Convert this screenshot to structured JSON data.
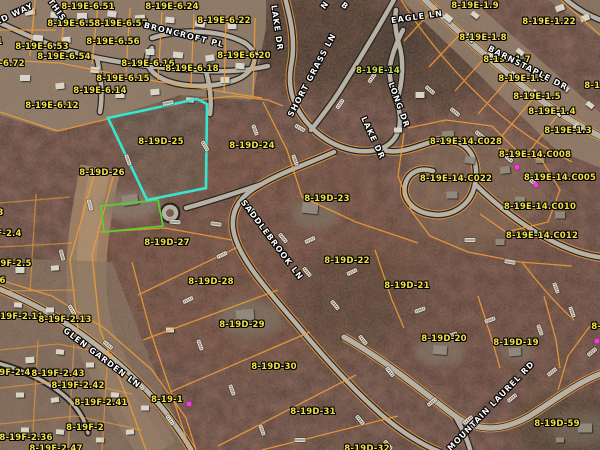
{
  "map": {
    "selected_parcel": "8-19D-25",
    "colors": {
      "highlight": "#38e6d0",
      "green_parcel": "#5ccc30",
      "parcel_line": "#ef9d38",
      "parcel_label": "#f2e245",
      "street_label": "#ffffff",
      "marker_magenta": "#f23ae2"
    },
    "parcel_labels": [
      {
        "t": "8-19E-6.51",
        "x": 88,
        "y": 7
      },
      {
        "t": "8-19E-6.24",
        "x": 172,
        "y": 7
      },
      {
        "t": "8-19E-6.52",
        "x": 74,
        "y": 24
      },
      {
        "t": "8-19E-6.57",
        "x": 121,
        "y": 24
      },
      {
        "t": "8-19E-6.22",
        "x": 224,
        "y": 21
      },
      {
        "t": "8-19E-6.56",
        "x": 113,
        "y": 42
      },
      {
        "t": "8-19E-6.53",
        "x": 42,
        "y": 47
      },
      {
        "t": "8-19E-6.54",
        "x": 64,
        "y": 57
      },
      {
        "t": "8-19E-6.20",
        "x": 244,
        "y": 56
      },
      {
        "t": "8-19E-6.16",
        "x": 148,
        "y": 64
      },
      {
        "t": "8-19E-6.18",
        "x": 192,
        "y": 69
      },
      {
        "t": "8-19E-6.15",
        "x": 123,
        "y": 79
      },
      {
        "t": "8-19E-6.14",
        "x": 100,
        "y": 91
      },
      {
        "t": "8-19E-6.12",
        "x": 52,
        "y": 106
      },
      {
        "t": "8-19E-6.72",
        "x": -2,
        "y": 64
      },
      {
        "t": "8-19E-6.71",
        "x": -24,
        "y": 42
      },
      {
        "t": "8-19E-14",
        "x": 378,
        "y": 71,
        "c": "#cde24c"
      },
      {
        "t": "8-19E-1.9",
        "x": 475,
        "y": 6
      },
      {
        "t": "8-19E-1.22",
        "x": 549,
        "y": 22
      },
      {
        "t": "8-19E-1.8",
        "x": 483,
        "y": 38
      },
      {
        "t": "8-19E-1.7",
        "x": 507,
        "y": 60
      },
      {
        "t": "8-19E-1.6",
        "x": 522,
        "y": 79
      },
      {
        "t": "8-19E-1.5",
        "x": 537,
        "y": 97
      },
      {
        "t": "8-19E-1.4",
        "x": 552,
        "y": 112
      },
      {
        "t": "8-19E-1.3",
        "x": 568,
        "y": 131
      },
      {
        "t": "8-19E-1.2",
        "x": 608,
        "y": 86
      },
      {
        "t": "8-19E-14.C028",
        "x": 466,
        "y": 142
      },
      {
        "t": "8-19E-14.C008",
        "x": 535,
        "y": 155
      },
      {
        "t": "8-19E-14.C022",
        "x": 456,
        "y": 179
      },
      {
        "t": "8-19E-14.C005",
        "x": 560,
        "y": 178
      },
      {
        "t": "8-19E-14.C010",
        "x": 540,
        "y": 207
      },
      {
        "t": "8-19E-14.C012",
        "x": 542,
        "y": 236
      },
      {
        "t": "8-19D-25",
        "x": 161,
        "y": 142
      },
      {
        "t": "8-19D-24",
        "x": 252,
        "y": 146
      },
      {
        "t": "8-19D-26",
        "x": 102,
        "y": 173
      },
      {
        "t": "8-19D-23",
        "x": 327,
        "y": 199
      },
      {
        "t": "8-19D-22",
        "x": 347,
        "y": 261
      },
      {
        "t": "8-19D-21",
        "x": 407,
        "y": 286
      },
      {
        "t": "8-19D-27",
        "x": 167,
        "y": 243
      },
      {
        "t": "8-19D-28",
        "x": 211,
        "y": 282
      },
      {
        "t": "8-19D-29",
        "x": 242,
        "y": 325
      },
      {
        "t": "8-19D-30",
        "x": 274,
        "y": 367
      },
      {
        "t": "8-19D-31",
        "x": 313,
        "y": 412
      },
      {
        "t": "8-19D-20",
        "x": 444,
        "y": 339
      },
      {
        "t": "8-19D-19",
        "x": 516,
        "y": 343
      },
      {
        "t": "8-19D-59",
        "x": 557,
        "y": 424
      },
      {
        "t": "8-19D-18",
        "x": 614,
        "y": 327
      },
      {
        "t": "8-19D-32",
        "x": 367,
        "y": 449
      },
      {
        "t": "8-19-1",
        "x": 167,
        "y": 400
      },
      {
        "t": "8-19F-2.3",
        "x": -20,
        "y": 213
      },
      {
        "t": "8-19F-2.4",
        "x": -2,
        "y": 234
      },
      {
        "t": "8-19F-2.5",
        "x": 8,
        "y": 264
      },
      {
        "t": "8-19F-2.6",
        "x": -18,
        "y": 281
      },
      {
        "t": "8-19F-2.11",
        "x": 17,
        "y": 317
      },
      {
        "t": "8-19F-2.13",
        "x": 65,
        "y": 320
      },
      {
        "t": "8-19F-2.45",
        "x": 10,
        "y": 373
      },
      {
        "t": "8-19F-2.43",
        "x": 58,
        "y": 374
      },
      {
        "t": "8-19F-2.42",
        "x": 78,
        "y": 386
      },
      {
        "t": "8-19F-2.41",
        "x": 101,
        "y": 403
      },
      {
        "t": "8-19F-2",
        "x": 85,
        "y": 428
      },
      {
        "t": "8-19F-2.36",
        "x": 26,
        "y": 438
      },
      {
        "t": "8-19F-2.47",
        "x": 56,
        "y": 449
      }
    ],
    "street_labels": [
      {
        "t": "RD WAY",
        "x": 14,
        "y": 14,
        "r": -25
      },
      {
        "t": "THIS",
        "x": 57,
        "y": 10,
        "r": 55
      },
      {
        "t": "BRONCROFT PL",
        "x": 184,
        "y": 35,
        "r": 14
      },
      {
        "t": "EAGLE LN",
        "x": 417,
        "y": 17,
        "r": -8
      },
      {
        "t": "LAKE DR",
        "x": 277,
        "y": 28,
        "r": 82
      },
      {
        "t": "SHORT GRASS LN",
        "x": 312,
        "y": 75,
        "r": -62
      },
      {
        "t": "BARNSTAPLE DR",
        "x": 528,
        "y": 68,
        "r": 27
      },
      {
        "t": "LONG DR",
        "x": 399,
        "y": 105,
        "r": 70
      },
      {
        "t": "LAKE DR",
        "x": 373,
        "y": 138,
        "r": 65
      },
      {
        "t": "SADDLEBROOK LN",
        "x": 272,
        "y": 240,
        "r": 53
      },
      {
        "t": "GLEN GARDEN LN",
        "x": 102,
        "y": 358,
        "r": 37
      },
      {
        "t": "MOUNTAIN LAUREL RD",
        "x": 491,
        "y": 406,
        "r": -46
      },
      {
        "t": "N",
        "x": 325,
        "y": 5,
        "r": -55
      },
      {
        "t": "B",
        "x": 345,
        "y": 6,
        "r": 40
      }
    ],
    "magenta_markers": [
      [
        517,
        167
      ],
      [
        536,
        185
      ],
      [
        189,
        404
      ],
      [
        597,
        341
      ]
    ],
    "dimension_markers": [
      [
        168,
        103,
        -12
      ],
      [
        205,
        146,
        60
      ],
      [
        128,
        160,
        70
      ],
      [
        175,
        222,
        5
      ],
      [
        216,
        224,
        8
      ],
      [
        250,
        208,
        40
      ],
      [
        283,
        238,
        50
      ],
      [
        307,
        272,
        50
      ],
      [
        335,
        305,
        50
      ],
      [
        363,
        340,
        50
      ],
      [
        390,
        372,
        50
      ],
      [
        255,
        130,
        70
      ],
      [
        295,
        160,
        70
      ],
      [
        222,
        255,
        -25
      ],
      [
        188,
        300,
        -25
      ],
      [
        200,
        345,
        70
      ],
      [
        232,
        390,
        70
      ],
      [
        262,
        430,
        70
      ],
      [
        310,
        240,
        -25
      ],
      [
        352,
        272,
        -25
      ],
      [
        300,
        128,
        30
      ],
      [
        340,
        104,
        -55
      ],
      [
        372,
        78,
        -55
      ],
      [
        430,
        90,
        40
      ],
      [
        455,
        112,
        40
      ],
      [
        480,
        135,
        40
      ],
      [
        508,
        158,
        40
      ],
      [
        533,
        182,
        40
      ],
      [
        470,
        240,
        0
      ],
      [
        510,
        262,
        10
      ],
      [
        556,
        288,
        70
      ],
      [
        572,
        312,
        70
      ],
      [
        420,
        310,
        -20
      ],
      [
        452,
        335,
        -20
      ],
      [
        490,
        320,
        -20
      ],
      [
        540,
        330,
        70
      ],
      [
        90,
        205,
        75
      ],
      [
        62,
        255,
        75
      ],
      [
        72,
        310,
        60
      ],
      [
        108,
        345,
        40
      ],
      [
        140,
        385,
        50
      ],
      [
        170,
        420,
        55
      ],
      [
        432,
        402,
        -40
      ],
      [
        468,
        420,
        -40
      ],
      [
        512,
        398,
        -40
      ],
      [
        552,
        372,
        -40
      ],
      [
        592,
        352,
        -40
      ],
      [
        360,
        420,
        50
      ],
      [
        388,
        445,
        50
      ],
      [
        300,
        440,
        0
      ]
    ],
    "houses": [
      [
        30,
        12,
        10,
        6,
        -10,
        0
      ],
      [
        55,
        15,
        9,
        6,
        5,
        0
      ],
      [
        82,
        16,
        10,
        6,
        0,
        0
      ],
      [
        112,
        14,
        9,
        6,
        8,
        0
      ],
      [
        140,
        18,
        10,
        6,
        -6,
        0
      ],
      [
        170,
        20,
        9,
        6,
        4,
        0
      ],
      [
        200,
        24,
        10,
        6,
        10,
        0
      ],
      [
        232,
        26,
        9,
        6,
        0,
        0
      ],
      [
        38,
        38,
        10,
        6,
        6,
        0
      ],
      [
        66,
        40,
        9,
        6,
        -5,
        0
      ],
      [
        150,
        52,
        9,
        6,
        0,
        0
      ],
      [
        178,
        55,
        10,
        6,
        6,
        0
      ],
      [
        210,
        58,
        9,
        6,
        -8,
        0
      ],
      [
        240,
        66,
        9,
        6,
        4,
        0
      ],
      [
        25,
        78,
        10,
        6,
        0,
        0
      ],
      [
        60,
        86,
        9,
        6,
        -6,
        0
      ],
      [
        95,
        70,
        9,
        6,
        5,
        0
      ],
      [
        120,
        95,
        9,
        6,
        0,
        0
      ],
      [
        155,
        92,
        9,
        6,
        -5,
        0
      ],
      [
        225,
        80,
        9,
        6,
        0,
        0
      ],
      [
        255,
        55,
        8,
        5,
        0,
        0
      ],
      [
        190,
        100,
        8,
        5,
        4,
        0
      ],
      [
        448,
        18,
        9,
        6,
        38,
        0
      ],
      [
        470,
        38,
        9,
        6,
        38,
        0
      ],
      [
        492,
        56,
        9,
        6,
        38,
        0
      ],
      [
        514,
        76,
        9,
        6,
        38,
        0
      ],
      [
        536,
        94,
        9,
        6,
        38,
        0
      ],
      [
        558,
        112,
        9,
        6,
        38,
        0
      ],
      [
        578,
        128,
        9,
        6,
        38,
        0
      ],
      [
        475,
        15,
        8,
        5,
        38,
        0
      ],
      [
        520,
        52,
        8,
        5,
        38,
        0
      ],
      [
        565,
        88,
        8,
        5,
        38,
        0
      ],
      [
        590,
        105,
        8,
        5,
        38,
        0
      ],
      [
        560,
        8,
        9,
        6,
        -20,
        0
      ],
      [
        585,
        18,
        9,
        6,
        -20,
        0
      ],
      [
        448,
        135,
        12,
        8,
        -5,
        1
      ],
      [
        470,
        160,
        10,
        7,
        10,
        1
      ],
      [
        452,
        195,
        11,
        7,
        0,
        1
      ],
      [
        505,
        170,
        10,
        7,
        -8,
        1
      ],
      [
        520,
        200,
        10,
        7,
        5,
        1
      ],
      [
        540,
        160,
        9,
        6,
        0,
        1
      ],
      [
        560,
        215,
        10,
        7,
        0,
        1
      ],
      [
        500,
        242,
        9,
        6,
        0,
        1
      ],
      [
        420,
        95,
        9,
        6,
        0,
        0
      ],
      [
        398,
        130,
        8,
        5,
        0,
        0
      ],
      [
        130,
        200,
        16,
        10,
        -8,
        1
      ],
      [
        310,
        208,
        16,
        11,
        6,
        1
      ],
      [
        245,
        315,
        18,
        11,
        -5,
        1
      ],
      [
        440,
        350,
        14,
        9,
        5,
        1
      ],
      [
        515,
        352,
        12,
        8,
        -6,
        1
      ],
      [
        585,
        428,
        14,
        9,
        0,
        1
      ],
      [
        20,
        270,
        9,
        6,
        0,
        0
      ],
      [
        55,
        268,
        8,
        5,
        -6,
        0
      ],
      [
        18,
        305,
        8,
        5,
        5,
        0
      ],
      [
        50,
        310,
        8,
        5,
        0,
        0
      ],
      [
        30,
        360,
        9,
        6,
        -5,
        0
      ],
      [
        60,
        352,
        8,
        5,
        6,
        0
      ],
      [
        90,
        365,
        8,
        5,
        0,
        0
      ],
      [
        20,
        395,
        8,
        5,
        0,
        0
      ],
      [
        55,
        400,
        8,
        5,
        -8,
        0
      ],
      [
        115,
        395,
        8,
        5,
        5,
        0
      ],
      [
        145,
        408,
        8,
        5,
        0,
        0
      ],
      [
        25,
        430,
        8,
        5,
        0,
        0
      ],
      [
        60,
        432,
        8,
        5,
        5,
        0
      ],
      [
        100,
        440,
        8,
        5,
        0,
        0
      ],
      [
        130,
        432,
        8,
        5,
        -5,
        0
      ],
      [
        170,
        330,
        8,
        5,
        0,
        0
      ],
      [
        560,
        440,
        8,
        5,
        0,
        1
      ]
    ]
  }
}
